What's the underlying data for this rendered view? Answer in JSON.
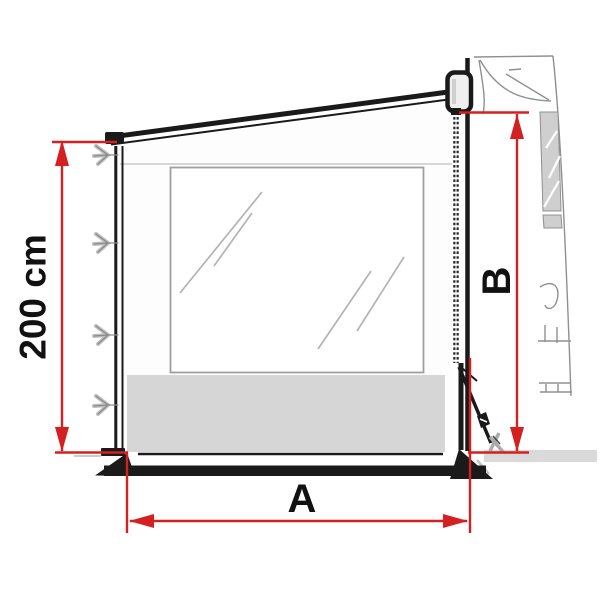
{
  "title": "Awning side panel dimension diagram",
  "diagram": {
    "type": "technical-illustration",
    "subject": "awning side wall panel with window, attached to vehicle via zipper, with ground pole and tension strap",
    "dimensions": {
      "left_height": {
        "label": "200 cm",
        "orientation": "vertical",
        "measures": "front pole height of side panel"
      },
      "right_height": {
        "label": "B",
        "orientation": "vertical",
        "measures": "height at vehicle side"
      },
      "bottom_width": {
        "label": "A",
        "orientation": "horizontal",
        "measures": "panel width along the ground"
      }
    }
  },
  "colors": {
    "dimension_red": "#d42020",
    "panel_outline": "#1a1a1a",
    "panel_skirt_gray": "#d6d6d6",
    "vehicle_window_gray": "#cfcfcf",
    "sketch_gray": "#909090",
    "ground_gray": "#d9d9d9"
  }
}
